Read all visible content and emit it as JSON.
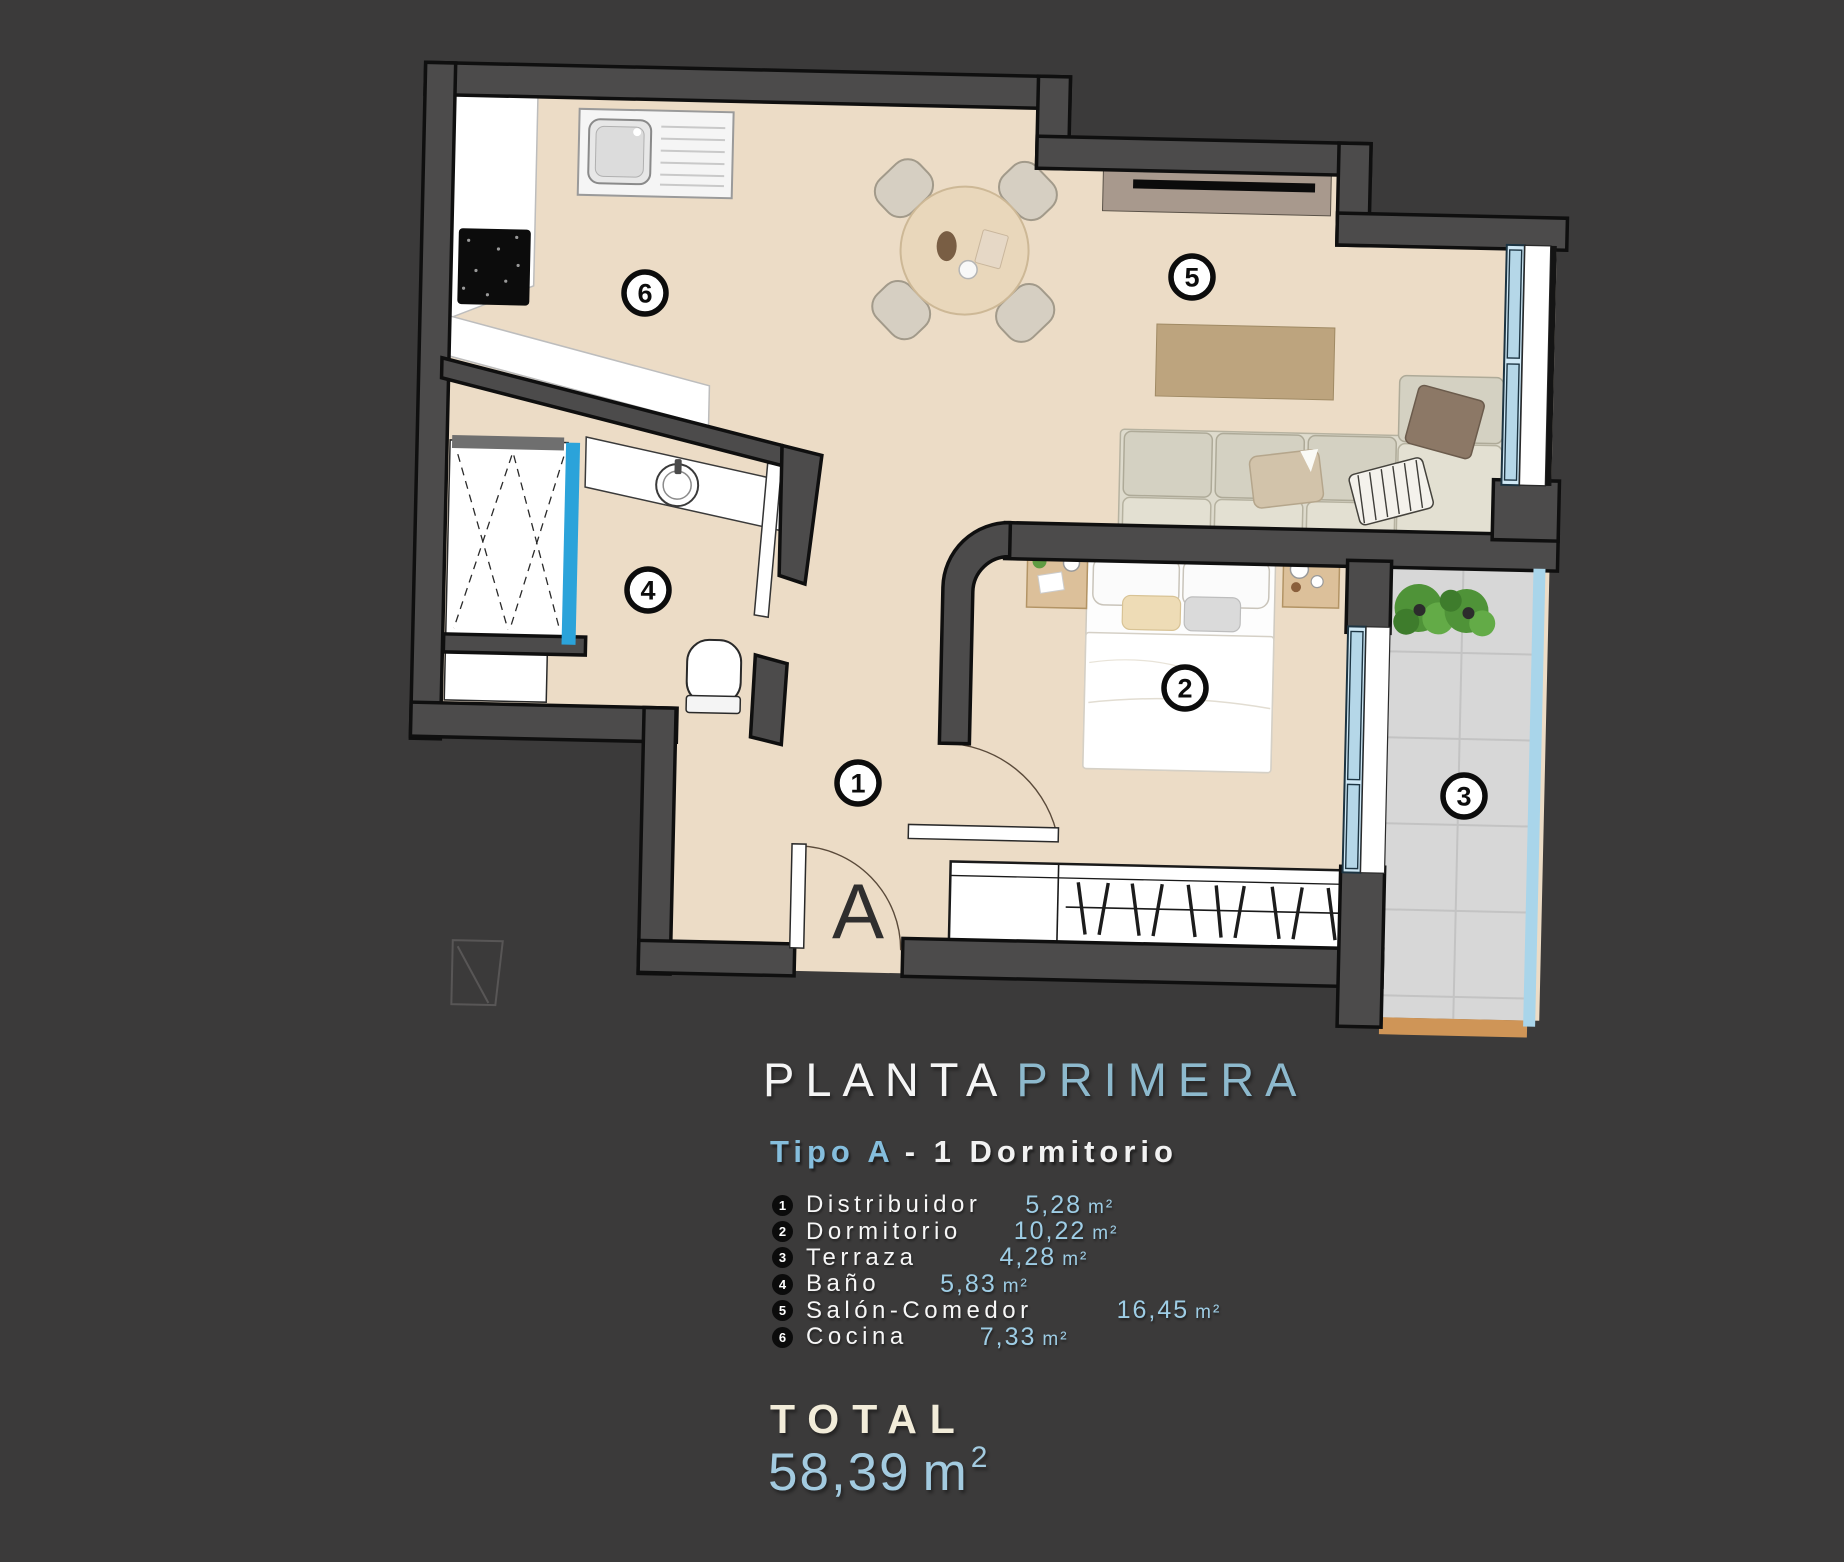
{
  "title": {
    "part1": "PLANTA",
    "part2": "PRIMERA"
  },
  "subtitle": {
    "part1": "Tipo A",
    "part2": "- 1  Dormitorio"
  },
  "legend": {
    "rooms": [
      {
        "num": "1",
        "name": "Distribuidor",
        "area": "5,28",
        "unit": "m²"
      },
      {
        "num": "2",
        "name": "Dormitorio",
        "area": "10,22",
        "unit": "m²"
      },
      {
        "num": "3",
        "name": "Terraza",
        "area": "4,28",
        "unit": "m²"
      },
      {
        "num": "4",
        "name": "Baño",
        "area": "5,83",
        "unit": "m²"
      },
      {
        "num": "5",
        "name": "Salón-Comedor",
        "area": "16,45",
        "unit": "m²"
      },
      {
        "num": "6",
        "name": "Cocina",
        "area": "7,33",
        "unit": "m²"
      }
    ]
  },
  "total": {
    "label": "TOTAL",
    "value": "58,39",
    "unit": "m",
    "sup": "2"
  },
  "plan": {
    "badges": [
      "1",
      "2",
      "3",
      "4",
      "5",
      "6"
    ],
    "entrance_label": "A"
  },
  "colors": {
    "background": "#3b3a3a",
    "accent_blue": "#8db9cd",
    "area_blue": "#9ecde5",
    "floor_beige": "#ecdcc6",
    "glass_blue": "#b5d7e8",
    "railing_blue": "#a9d5ea",
    "shower_glass": "#2ba3da",
    "terrace_orange": "#cf9557"
  }
}
